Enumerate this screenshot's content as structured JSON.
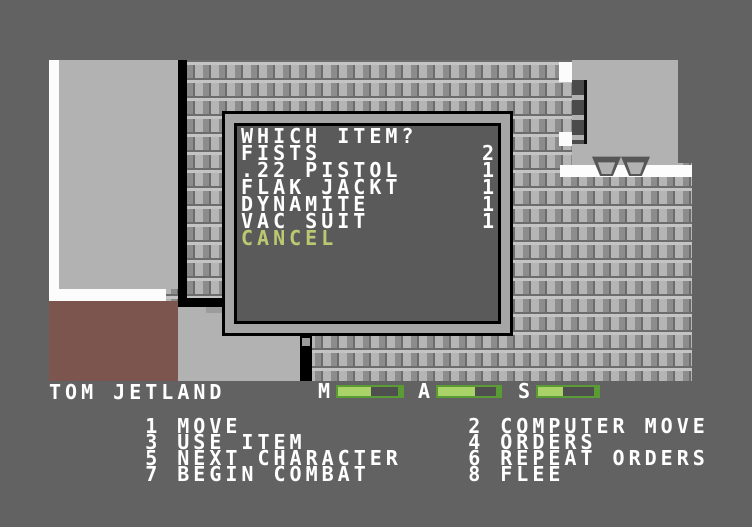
{
  "dialog": {
    "title": "WHICH ITEM?",
    "items": [
      {
        "name": "FISTS",
        "count": "2"
      },
      {
        "name": ".22 PISTOL",
        "count": "1"
      },
      {
        "name": "FLAK JACKT",
        "count": "1"
      },
      {
        "name": "DYNAMITE",
        "count": "1"
      },
      {
        "name": "VAC SUIT",
        "count": "1"
      }
    ],
    "cancel_label": "CANCEL"
  },
  "hud": {
    "character_name": "TOM JETLAND",
    "stats": [
      {
        "label": "M",
        "fill": 55
      },
      {
        "label": "A",
        "fill": 64
      },
      {
        "label": "S",
        "fill": 44
      }
    ],
    "menu_left": [
      {
        "key": "1",
        "label": "MOVE"
      },
      {
        "key": "3",
        "label": "USE ITEM"
      },
      {
        "key": "5",
        "label": "NEXT CHARACTER"
      },
      {
        "key": "7",
        "label": "BEGIN COMBAT"
      }
    ],
    "menu_right": [
      {
        "key": "2",
        "label": "COMPUTER MOVE"
      },
      {
        "key": "4",
        "label": "ORDERS"
      },
      {
        "key": "6",
        "label": "REPEAT ORDERS"
      },
      {
        "key": "8",
        "label": "FLEE"
      }
    ]
  },
  "colors": {
    "accent_yellow": "#bdc971",
    "accent_cyan": "#73b5c1",
    "bar_green_border": "#5a9b36",
    "bar_green_fill": "#a9d368",
    "room_maroon": "#7c564e"
  }
}
